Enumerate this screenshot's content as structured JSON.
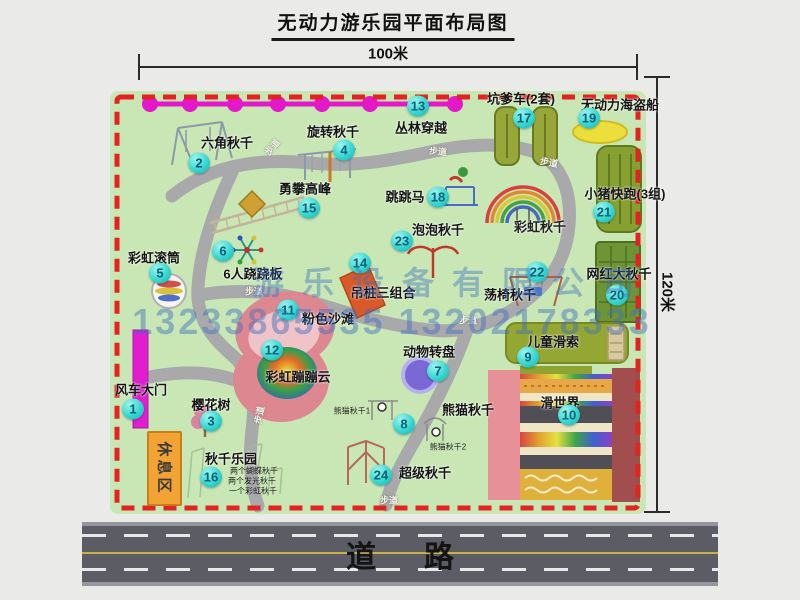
{
  "title": "无动力游乐园平面布局图",
  "dimensions": {
    "top": "100米",
    "right": "120米"
  },
  "road_label": "道路",
  "watermark": {
    "company": "游乐设备有限公司",
    "phones": "13233865535 13202178333"
  },
  "rest_area_label": "休息区",
  "walkway_label": "步道",
  "colors": {
    "map_green": "#c9e7b5",
    "border_red": "#e32222",
    "badge_cyan": "#38d6d0",
    "zipline_magenta": "#e318c8",
    "road_gray": "#5c5c64"
  },
  "walkways": [
    {
      "x": 272,
      "y": 147,
      "r": -50
    },
    {
      "x": 438,
      "y": 151,
      "r": 5
    },
    {
      "x": 549,
      "y": 162,
      "r": 10
    },
    {
      "x": 254,
      "y": 291,
      "r": 0
    },
    {
      "x": 468,
      "y": 320,
      "r": 0
    },
    {
      "x": 259,
      "y": 415,
      "r": -78
    },
    {
      "x": 389,
      "y": 500,
      "r": 0
    }
  ],
  "locations": [
    {
      "num": "1",
      "name": "风车大门",
      "bx": 133,
      "by": 409,
      "lx": 141,
      "ly": 389
    },
    {
      "num": "2",
      "name": "六角秋千",
      "bx": 199,
      "by": 163,
      "lx": 227,
      "ly": 142
    },
    {
      "num": "3",
      "name": "樱花树",
      "bx": 211,
      "by": 421,
      "lx": 211,
      "ly": 404
    },
    {
      "num": "4",
      "name": "旋转秋千",
      "bx": 344,
      "by": 150,
      "lx": 333,
      "ly": 131
    },
    {
      "num": "5",
      "name": "彩虹滚筒",
      "bx": 160,
      "by": 273,
      "lx": 154,
      "ly": 257
    },
    {
      "num": "6",
      "name": "6人跷跷板",
      "bx": 223,
      "by": 251,
      "lx": 253,
      "ly": 273
    },
    {
      "num": "7",
      "name": "动物转盘",
      "bx": 438,
      "by": 371,
      "lx": 429,
      "ly": 351
    },
    {
      "num": "8",
      "name": "熊猫秋千",
      "bx": 404,
      "by": 424,
      "lx": 468,
      "ly": 409
    },
    {
      "num": "9",
      "name": "儿童滑索",
      "bx": 528,
      "by": 357,
      "lx": 553,
      "ly": 341
    },
    {
      "num": "10",
      "name": "滑世界",
      "bx": 569,
      "by": 415,
      "lx": 560,
      "ly": 402
    },
    {
      "num": "11",
      "name": "粉色沙滩",
      "bx": 288,
      "by": 310,
      "lx": 328,
      "ly": 318
    },
    {
      "num": "12",
      "name": "彩虹蹦蹦云",
      "bx": 272,
      "by": 350,
      "lx": 298,
      "ly": 376
    },
    {
      "num": "13",
      "name": "丛林穿越",
      "bx": 418,
      "by": 106,
      "lx": 421,
      "ly": 127
    },
    {
      "num": "14",
      "name": "吊桩三组合",
      "bx": 360,
      "by": 263,
      "lx": 383,
      "ly": 292
    },
    {
      "num": "15",
      "name": "勇攀高峰",
      "bx": 309,
      "by": 208,
      "lx": 305,
      "ly": 188
    },
    {
      "num": "16",
      "name": "秋千乐园",
      "bx": 211,
      "by": 477,
      "lx": 231,
      "ly": 458
    },
    {
      "num": "17",
      "name": "坑爹车(2套)",
      "bx": 524,
      "by": 118,
      "lx": 521,
      "ly": 98
    },
    {
      "num": "18",
      "name": "跳跳马",
      "bx": 438,
      "by": 197,
      "lx": 405,
      "ly": 196
    },
    {
      "num": "19",
      "name": "无动力海盗船",
      "bx": 589,
      "by": 118,
      "lx": 620,
      "ly": 104
    },
    {
      "num": "20",
      "name": "网红大秋千",
      "bx": 617,
      "by": 295,
      "lx": 619,
      "ly": 273
    },
    {
      "num": "21",
      "name": "小猪快跑(3组)",
      "bx": 604,
      "by": 212,
      "lx": 625,
      "ly": 193
    },
    {
      "num": "22",
      "name": "荡椅秋千",
      "bx": 537,
      "by": 272,
      "lx": 510,
      "ly": 294
    },
    {
      "num": "23",
      "name": "泡泡秋千",
      "bx": 402,
      "by": 241,
      "lx": 438,
      "ly": 229
    },
    {
      "num": "24",
      "name": "超级秋千",
      "bx": 381,
      "by": 475,
      "lx": 425,
      "ly": 472
    }
  ],
  "sub_labels": [
    {
      "text": "彩虹秋千",
      "x": 540,
      "y": 226,
      "size": 13,
      "bold": true
    },
    {
      "text": "熊猫秋千1",
      "x": 352,
      "y": 411,
      "size": 8,
      "bold": false
    },
    {
      "text": "熊猫秋千2",
      "x": 448,
      "y": 447,
      "size": 8,
      "bold": false
    },
    {
      "text": "两个蝴蝶秋千",
      "x": 254,
      "y": 471,
      "size": 8,
      "bold": false
    },
    {
      "text": "两个发光秋千",
      "x": 252,
      "y": 481,
      "size": 8,
      "bold": false
    },
    {
      "text": "一个彩虹秋千",
      "x": 253,
      "y": 491,
      "size": 8,
      "bold": false
    }
  ]
}
